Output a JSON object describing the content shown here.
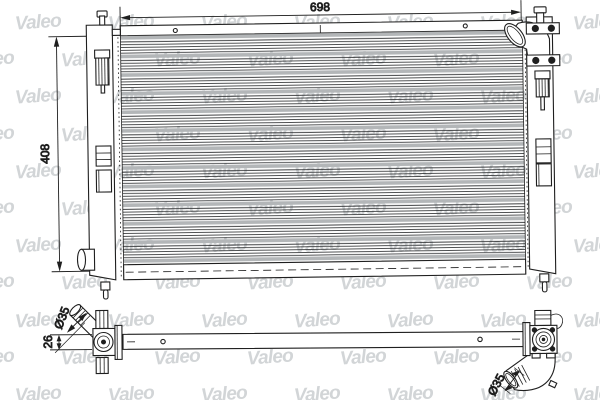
{
  "image": {
    "kind": "radiator-technical-drawing",
    "watermark": {
      "text": "Valeo"
    },
    "front_view": {
      "width_label": "698",
      "height_label": "408"
    },
    "side_view": {
      "thickness_label": "26",
      "pipe_left_diameter_label": "Ø35",
      "pipe_right_diameter_label": "Ø35"
    },
    "colors": {
      "background": "#ffffff",
      "line": "#1f1f1f",
      "fin_band": "#b3b6b8",
      "watermark": "#d2d5d7"
    }
  }
}
